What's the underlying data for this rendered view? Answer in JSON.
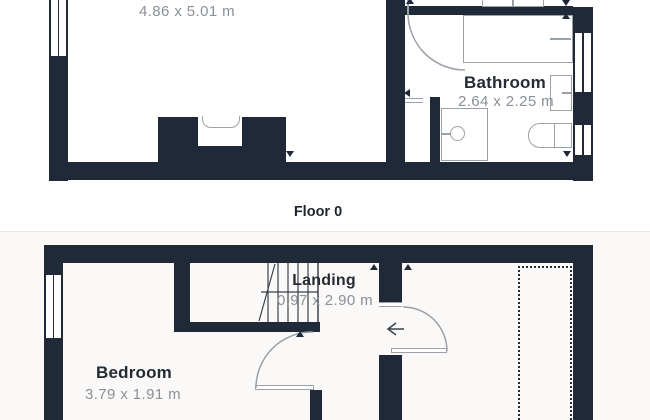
{
  "document": {
    "kind": "property-floorplan"
  },
  "floor0": {
    "caption": "Floor 0",
    "main_room": {
      "dims": "4.86 x 5.01 m"
    },
    "bathroom": {
      "name": "Bathroom",
      "dims": "2.64 x 2.25 m"
    }
  },
  "floor1": {
    "landing": {
      "name": "Landing",
      "dims": "0.97 x 2.90 m"
    },
    "bedroom": {
      "name": "Bedroom",
      "dims": "3.79 x 1.91 m"
    }
  },
  "colors": {
    "wall": "#1f2938",
    "fixture_outline": "#9aa1a9",
    "room_label": "#252b34",
    "dimension_text": "#8a9098",
    "lower_section_bg": "#faf9f7"
  }
}
